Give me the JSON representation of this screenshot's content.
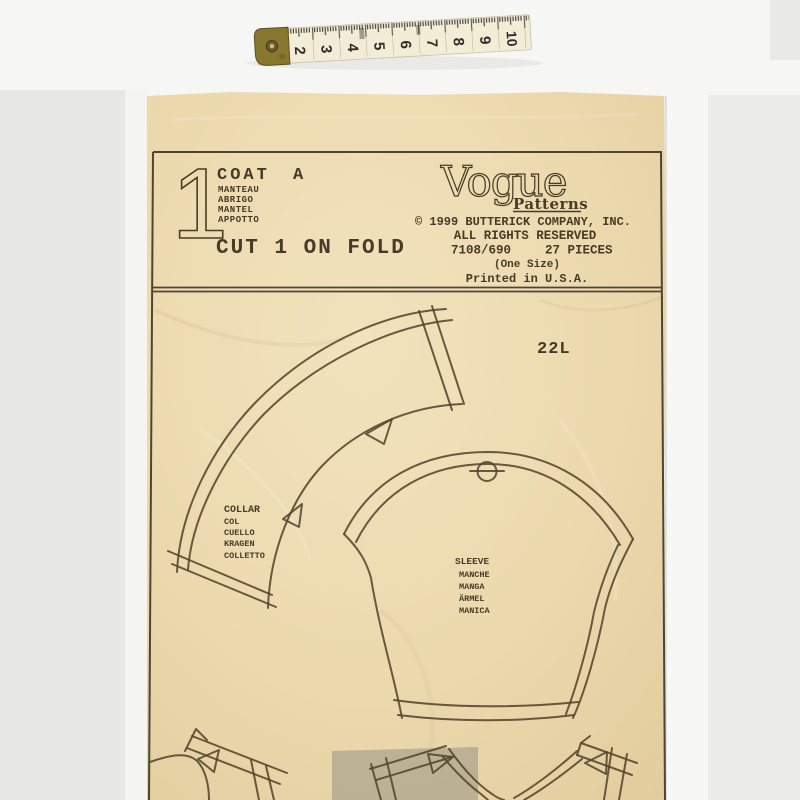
{
  "scene": {
    "measuring_tape": {
      "numbers": [
        "2",
        "3",
        "4",
        "5",
        "6",
        "7",
        "8",
        "9",
        "10"
      ]
    },
    "sheet": {
      "header": {
        "piece_number": "1",
        "garment": "COAT",
        "view": "A",
        "translations": [
          "MANTEAU",
          "ABRIGO",
          "MANTEL",
          "APPOTTO"
        ],
        "cutting_instruction": "CUT 1 ON FOLD",
        "brand": "Vogue",
        "brand_sub": "Patterns",
        "copyright_line": "© 1999 BUTTERICK COMPANY, INC.",
        "rights_line": "ALL RIGHTS RESERVED",
        "pattern_number": "7108/690",
        "pieces_count": "27 PIECES",
        "size_line": "(One Size)",
        "printed_line": "Printed in U.S.A."
      },
      "sheet_code": "22L",
      "collar_labels": [
        "COLLAR",
        "COL",
        "CUELLO",
        "KRAGEN",
        "COLLETTO"
      ],
      "sleeve_labels": [
        "SLEEVE",
        "MANCHE",
        "MANGA",
        "ÄRMEL",
        "MANICA"
      ],
      "colors": {
        "paper": "#ecd9ae",
        "ink": "#4a3c26",
        "backdrop": "#ebebea"
      }
    }
  }
}
